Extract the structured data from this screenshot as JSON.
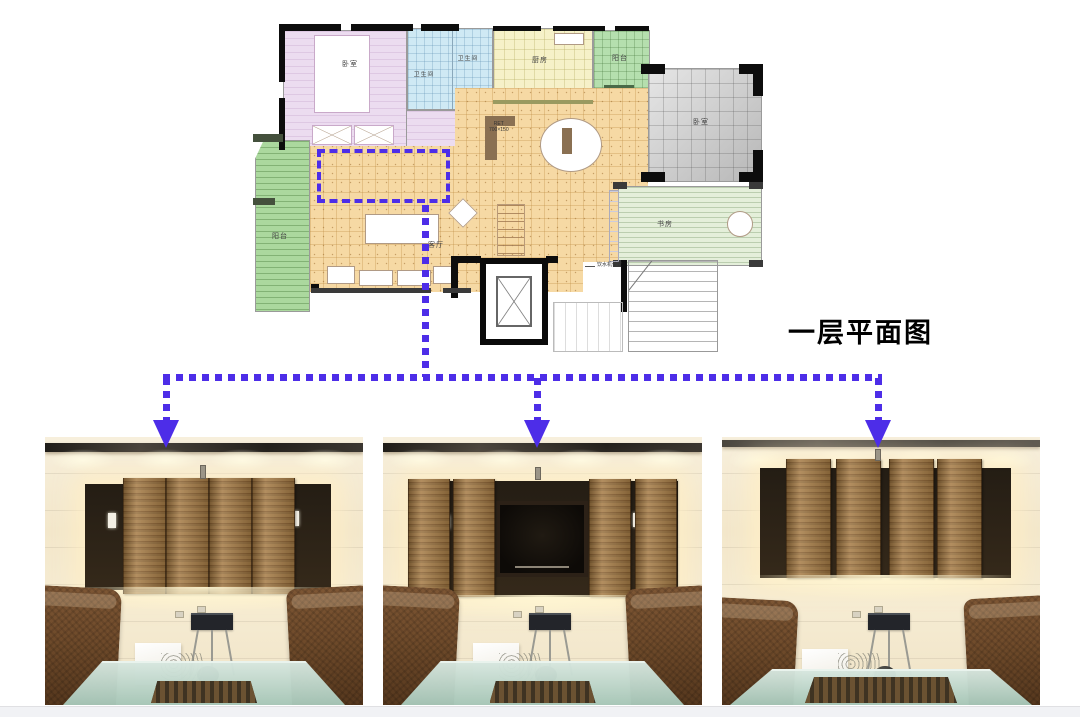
{
  "theme": {
    "accent_color": "#4d2de8",
    "wood_color": "#a67c46",
    "plan_colors": {
      "bedroom": "#ecdcf0",
      "bathroom": "#cfe9f4",
      "kitchen": "#f6f1c8",
      "balcony_north": "#b5dfae",
      "bedroom2_gray": "#c9c9c9",
      "study": "#e4efda",
      "balcony_west": "#abd89e",
      "living": "#f6d9a4"
    }
  },
  "title": {
    "text": "一层平面图"
  },
  "floor_plan": {
    "rooms": {
      "bedroom_main": {
        "label": "卧室"
      },
      "bathroom_1": {
        "label": "卫生间"
      },
      "bathroom_2": {
        "label": "卫生间"
      },
      "kitchen": {
        "label": "厨房"
      },
      "balcony_north": {
        "label": "阳台"
      },
      "bedroom_2": {
        "label": "卧室"
      },
      "study": {
        "label": "书房"
      },
      "balcony_west": {
        "label": "阳台"
      },
      "living_room": {
        "label": "客厅"
      }
    },
    "annotations": {
      "equipment_note": {
        "text": "饮水机位置"
      },
      "cabinet_tag_line1": {
        "text": "RET"
      },
      "cabinet_tag_line2": {
        "text": "700×150"
      }
    }
  },
  "photos": [
    {
      "id": "panels-closed",
      "tv_wall": [
        40,
        47,
        246,
        106
      ],
      "panels": {
        "y": 41,
        "h": 116,
        "w": 43,
        "x": [
          78,
          121,
          164,
          207
        ]
      },
      "speakers": [
        [
          63,
          76,
          8,
          15
        ],
        [
          246,
          74,
          8,
          15
        ]
      ],
      "sensor": [
        155,
        28,
        6,
        14
      ],
      "tv_screen": null
    },
    {
      "id": "panels-open",
      "tv_wall": [
        25,
        44,
        270,
        116
      ],
      "panels": {
        "y": 42,
        "h": 118,
        "w": 42,
        "x": [
          25,
          70,
          206,
          252
        ]
      },
      "speakers": [
        [
          60,
          78,
          7,
          14
        ],
        [
          250,
          76,
          7,
          14
        ]
      ],
      "sensor": [
        152,
        30,
        6,
        13
      ],
      "tv_screen": [
        113,
        64,
        92,
        76
      ]
    },
    {
      "id": "panels-spread",
      "tv_wall": [
        38,
        31,
        251,
        110
      ],
      "panels": {
        "y": 22,
        "h": 119,
        "w": 45,
        "x": [
          64,
          114,
          167,
          215
        ]
      },
      "speakers": [],
      "sensor": [
        153,
        12,
        6,
        12
      ],
      "tv_screen": null
    }
  ]
}
